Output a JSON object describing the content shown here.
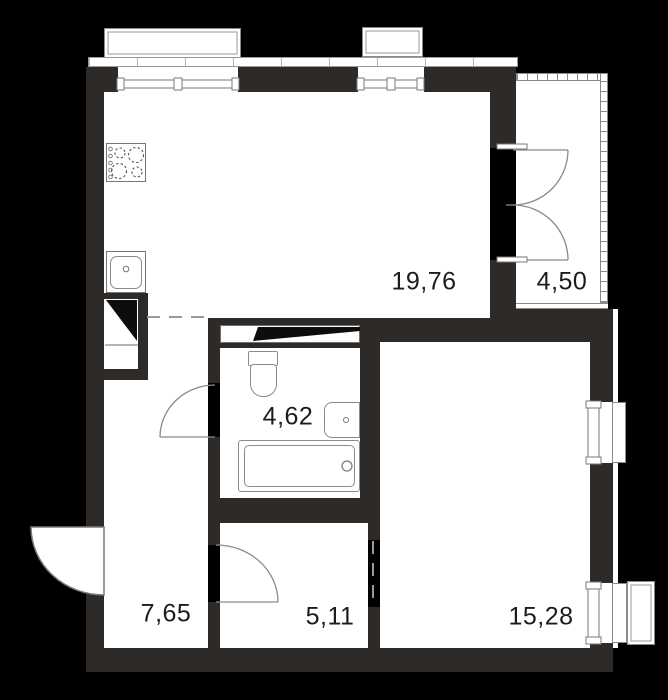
{
  "plan": {
    "title": "apartment-floor-plan",
    "rooms": [
      {
        "name": "living-kitchen",
        "area": "19,76"
      },
      {
        "name": "loggia",
        "area": "4,50"
      },
      {
        "name": "bathroom",
        "area": "4,62"
      },
      {
        "name": "hallway",
        "area": "7,65"
      },
      {
        "name": "corridor",
        "area": "5,11"
      },
      {
        "name": "bedroom",
        "area": "15,28"
      }
    ],
    "colors": {
      "background": "#000000",
      "wall": "#2e2a27",
      "floor": "#ffffff",
      "stroke": "#7a7a7a",
      "label": "#1c1c1c"
    },
    "fixtures": [
      "stove-icon",
      "kitchen-sink-icon",
      "vent-shaft-icon",
      "duct-icon",
      "toilet-icon",
      "bathroom-sink-icon",
      "bathtub-icon"
    ]
  }
}
